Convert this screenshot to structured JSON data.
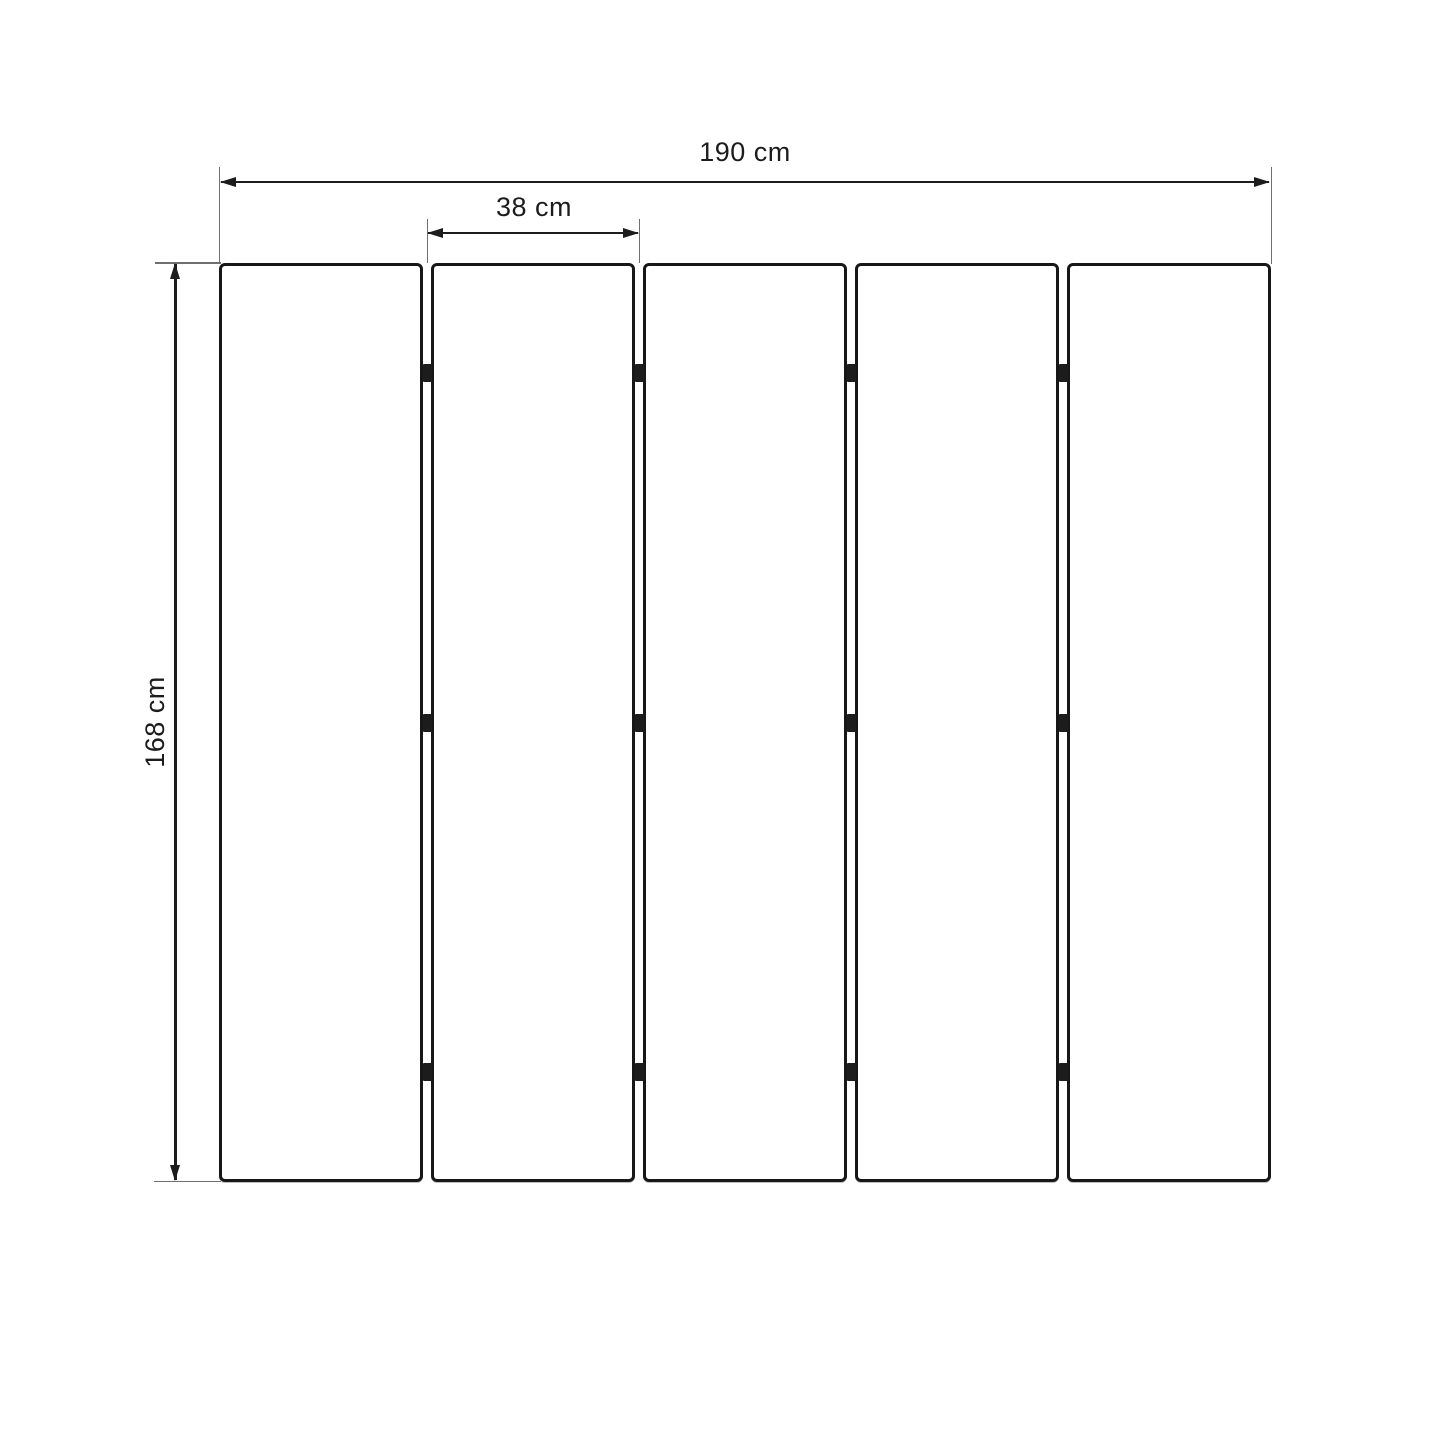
{
  "drawing": {
    "type": "dimensioned technical drawing",
    "panel_count": 5,
    "hinges": {
      "junctions": 4,
      "rows_per_junction": 3
    },
    "labels": {
      "total_width": "190 cm",
      "panel_width": "38 cm",
      "height": "168 cm"
    },
    "colors": {
      "background": "#ffffff",
      "line": "#1c1c1c",
      "extension_line": "#6f6f6f",
      "panel_border": "#171717"
    }
  }
}
